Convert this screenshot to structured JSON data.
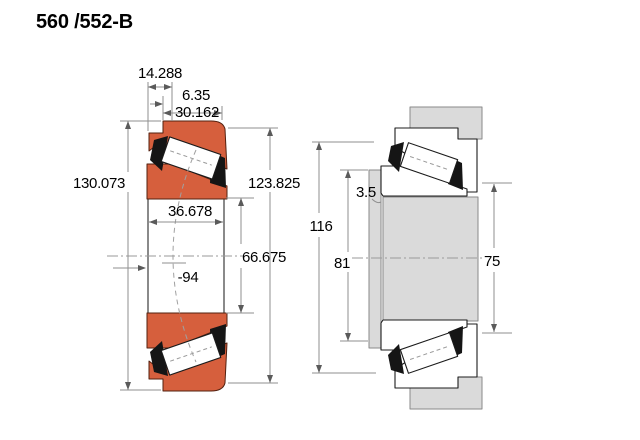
{
  "title": "560 /552-B",
  "left_view": {
    "description": "bearing cross-section, colored",
    "dims": {
      "d14": "14.288",
      "d6": "6.35",
      "d30": "30.162",
      "d130": "130.073",
      "d123": "123.825",
      "d36": "36.678",
      "d66": "66.675",
      "dm94": "-94"
    }
  },
  "right_view": {
    "description": "mounted arrangement, line drawing",
    "dims": {
      "d116": "116",
      "d81": "81",
      "d35": "3.5",
      "d75": "75"
    }
  },
  "colors": {
    "ring_fill": "#d65f3d",
    "metal_fill": "#dadada"
  }
}
